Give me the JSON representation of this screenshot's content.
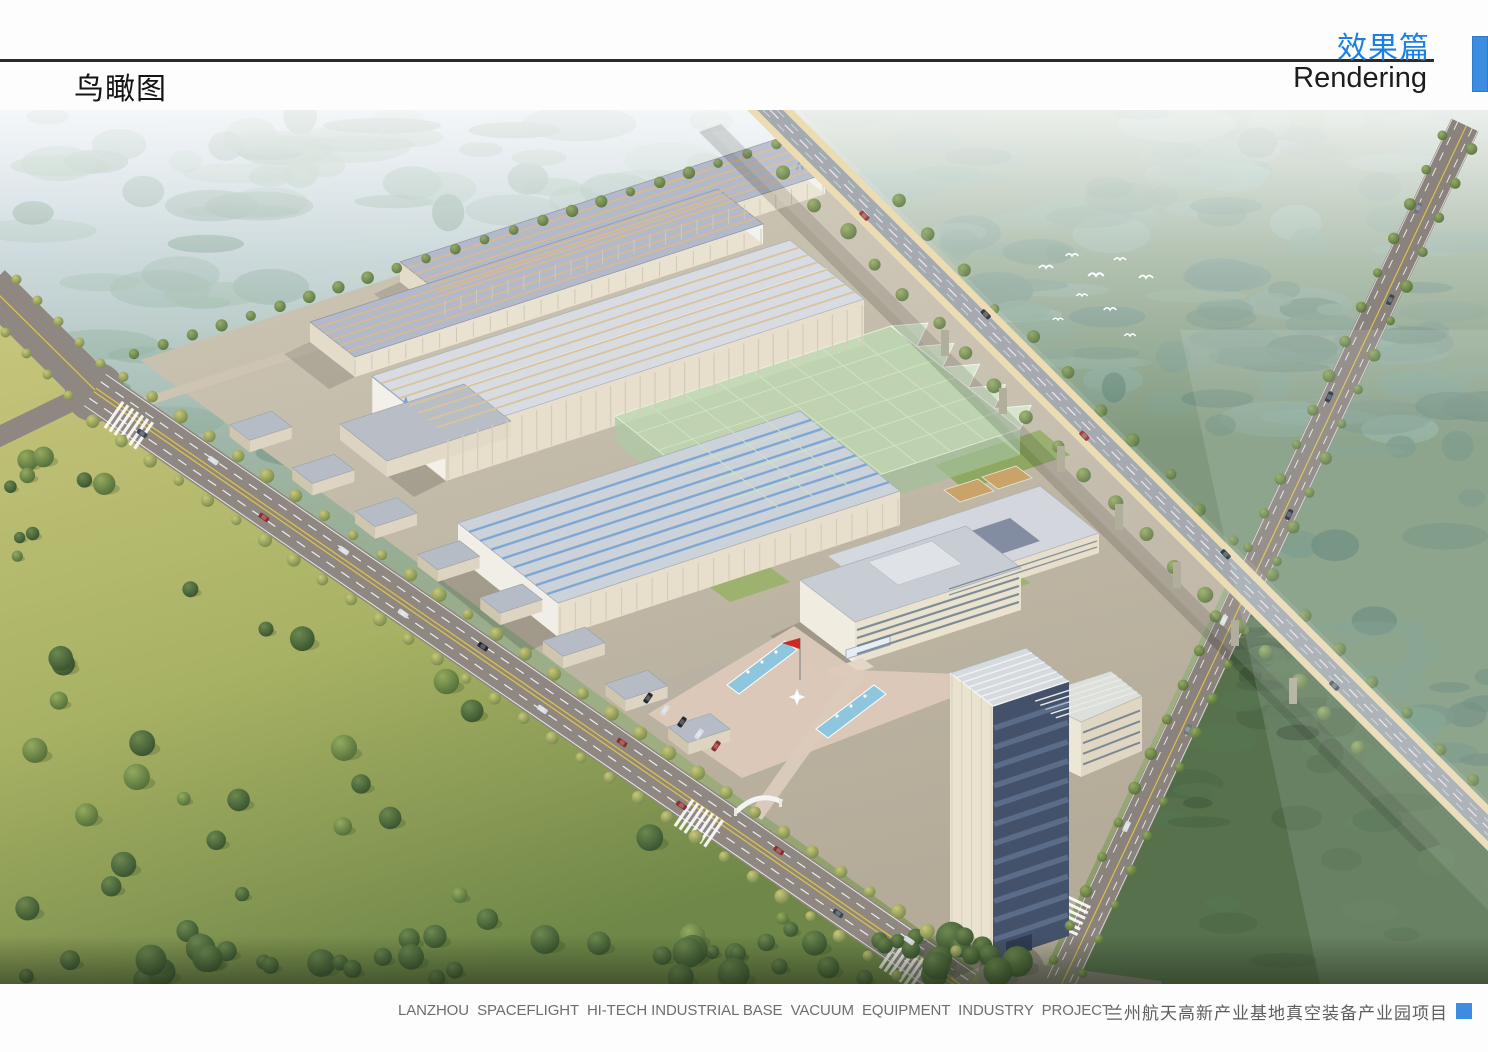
{
  "page": {
    "background": "#fdfdfd"
  },
  "header": {
    "view_title_zh": "鸟瞰图",
    "section_title_zh": "效果篇",
    "section_title_en": "Rendering",
    "rule_color": "#2b2b2b",
    "accent_color": "#3c8ce0"
  },
  "rendering": {
    "type": "aerial-birdseye-architectural-rendering"
  },
  "footer": {
    "caption_en": "LANZHOU  SPACEFLIGHT  HI-TECH INDUSTRIAL BASE  VACUUM  EQUIPMENT  INDUSTRY  PROJECT",
    "caption_zh": "兰州航天高新产业基地真空装备产业园项目",
    "marker_color": "#3c8ce0"
  }
}
